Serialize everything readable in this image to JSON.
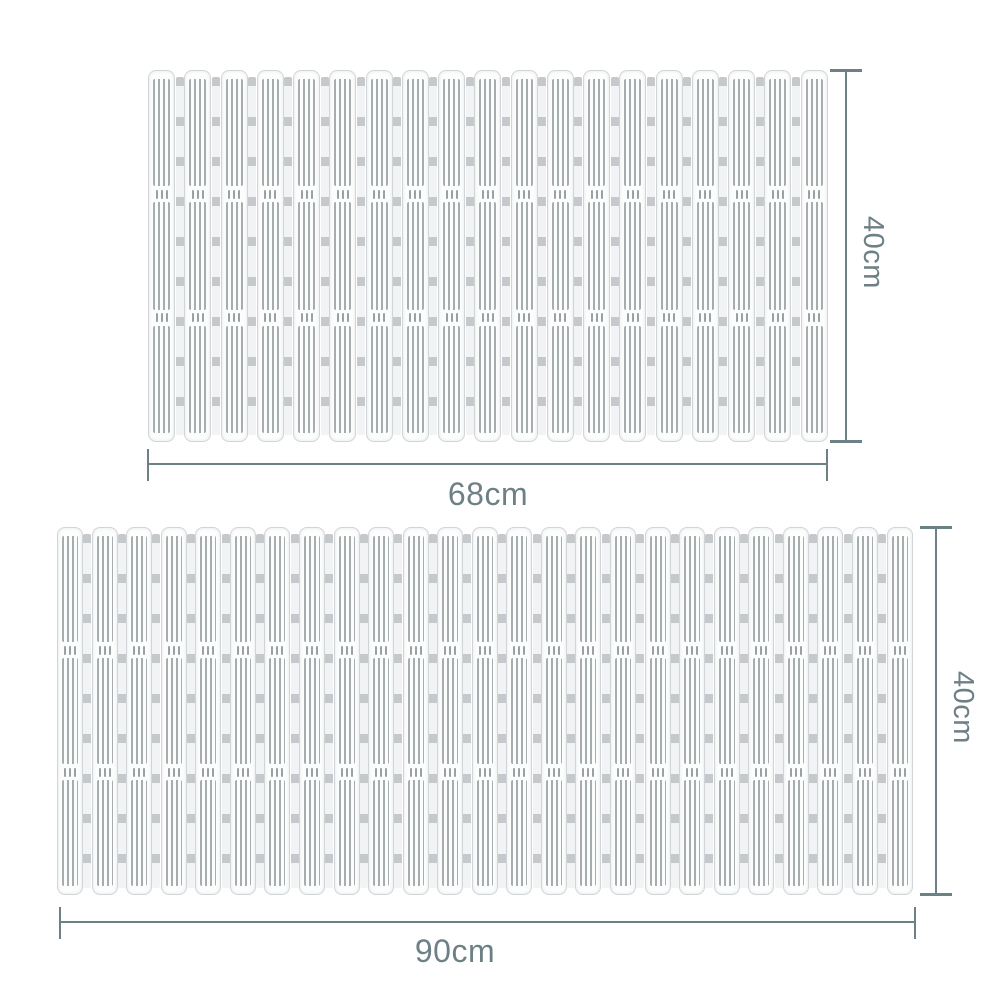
{
  "accent_color": "#6d8086",
  "diagram_title": "slatted mat size diagram",
  "mats": [
    {
      "id": "mat-small",
      "width_label": "68cm",
      "height_label": "40cm",
      "slat_count": 19,
      "segment_count": 3,
      "hinge_dashes": 3
    },
    {
      "id": "mat-large",
      "width_label": "90cm",
      "height_label": "40cm",
      "slat_count": 25,
      "segment_count": 3,
      "hinge_dashes": 3
    }
  ]
}
